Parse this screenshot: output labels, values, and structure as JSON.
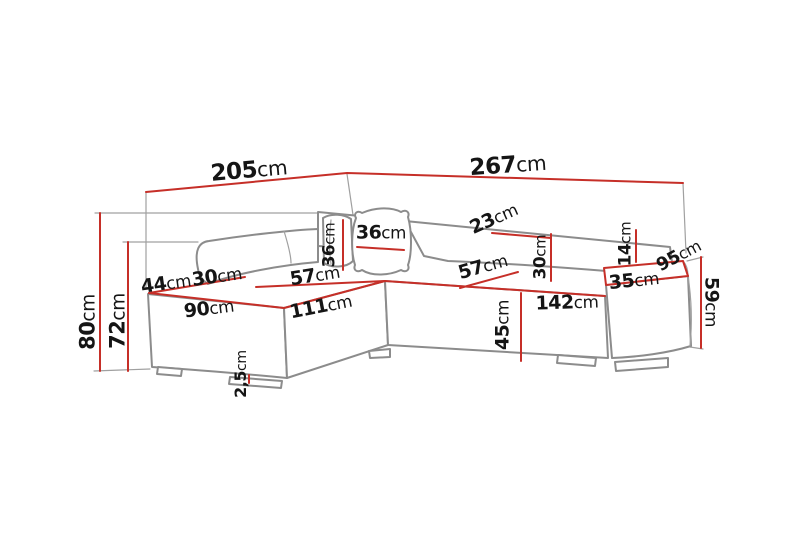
{
  "diagram": {
    "type": "furniture-dimension-diagram",
    "subject": "corner sofa with chaise, cushions and pouf armrest",
    "unit": "cm",
    "colors": {
      "dimension_line": "#c62f28",
      "outline": "#8c8c8c",
      "extension_line": "#a0a0a0",
      "text": "#151515",
      "background": "#ffffff"
    },
    "labels": [
      {
        "id": "total-width-left",
        "num": "205",
        "unit": "cm",
        "x": 249,
        "y": 171,
        "rot": -5,
        "size": 23
      },
      {
        "id": "total-width-right",
        "num": "267",
        "unit": "cm",
        "x": 508,
        "y": 166,
        "rot": -4,
        "size": 23
      },
      {
        "id": "total-height",
        "num": "80",
        "unit": "cm",
        "x": 88,
        "y": 322,
        "rot": -90,
        "size": 21
      },
      {
        "id": "back-height",
        "num": "72",
        "unit": "cm",
        "x": 118,
        "y": 321,
        "rot": -90,
        "size": 21
      },
      {
        "id": "chaise-side-edge",
        "num": "44",
        "unit": "cm",
        "x": 166,
        "y": 284,
        "rot": -8,
        "size": 19
      },
      {
        "id": "chaise-back-depth",
        "num": "30",
        "unit": "cm",
        "x": 217,
        "y": 277,
        "rot": -8,
        "size": 19
      },
      {
        "id": "corner-seat-width",
        "num": "57",
        "unit": "cm",
        "x": 315,
        "y": 276,
        "rot": -9,
        "size": 19
      },
      {
        "id": "chaise-front-width",
        "num": "90",
        "unit": "cm",
        "x": 209,
        "y": 309,
        "rot": -7,
        "size": 19
      },
      {
        "id": "chaise-length",
        "num": "111",
        "unit": "cm",
        "x": 321,
        "y": 307,
        "rot": -11,
        "size": 19
      },
      {
        "id": "pillow-side-size",
        "num": "36",
        "unit": "cm",
        "x": 330,
        "y": 245,
        "rot": -90,
        "size": 17
      },
      {
        "id": "pillow-front-size",
        "num": "36",
        "unit": "cm",
        "x": 381,
        "y": 233,
        "rot": 0,
        "size": 19
      },
      {
        "id": "backrest-top-depth",
        "num": "23",
        "unit": "cm",
        "x": 494,
        "y": 219,
        "rot": -24,
        "size": 19
      },
      {
        "id": "seat-depth",
        "num": "57",
        "unit": "cm",
        "x": 483,
        "y": 267,
        "rot": -16,
        "size": 19
      },
      {
        "id": "backrest-height",
        "num": "30",
        "unit": "cm",
        "x": 541,
        "y": 257,
        "rot": -90,
        "size": 17
      },
      {
        "id": "back-to-pouf-gap",
        "num": "14",
        "unit": "cm",
        "x": 626,
        "y": 244,
        "rot": -90,
        "size": 17
      },
      {
        "id": "pouf-depth",
        "num": "95",
        "unit": "cm",
        "x": 679,
        "y": 256,
        "rot": -28,
        "size": 18
      },
      {
        "id": "pouf-width",
        "num": "35",
        "unit": "cm",
        "x": 634,
        "y": 281,
        "rot": -6,
        "size": 19
      },
      {
        "id": "pouf-height",
        "num": "59",
        "unit": "cm",
        "x": 711,
        "y": 302,
        "rot": 90,
        "size": 19
      },
      {
        "id": "seat-front-width",
        "num": "142",
        "unit": "cm",
        "x": 567,
        "y": 303,
        "rot": -2,
        "size": 19
      },
      {
        "id": "seat-height",
        "num": "45",
        "unit": "cm",
        "x": 503,
        "y": 325,
        "rot": -90,
        "size": 19
      },
      {
        "id": "leg-height",
        "num": "2,5",
        "unit": "cm",
        "x": 241,
        "y": 374,
        "rot": -90,
        "size": 16
      }
    ]
  }
}
